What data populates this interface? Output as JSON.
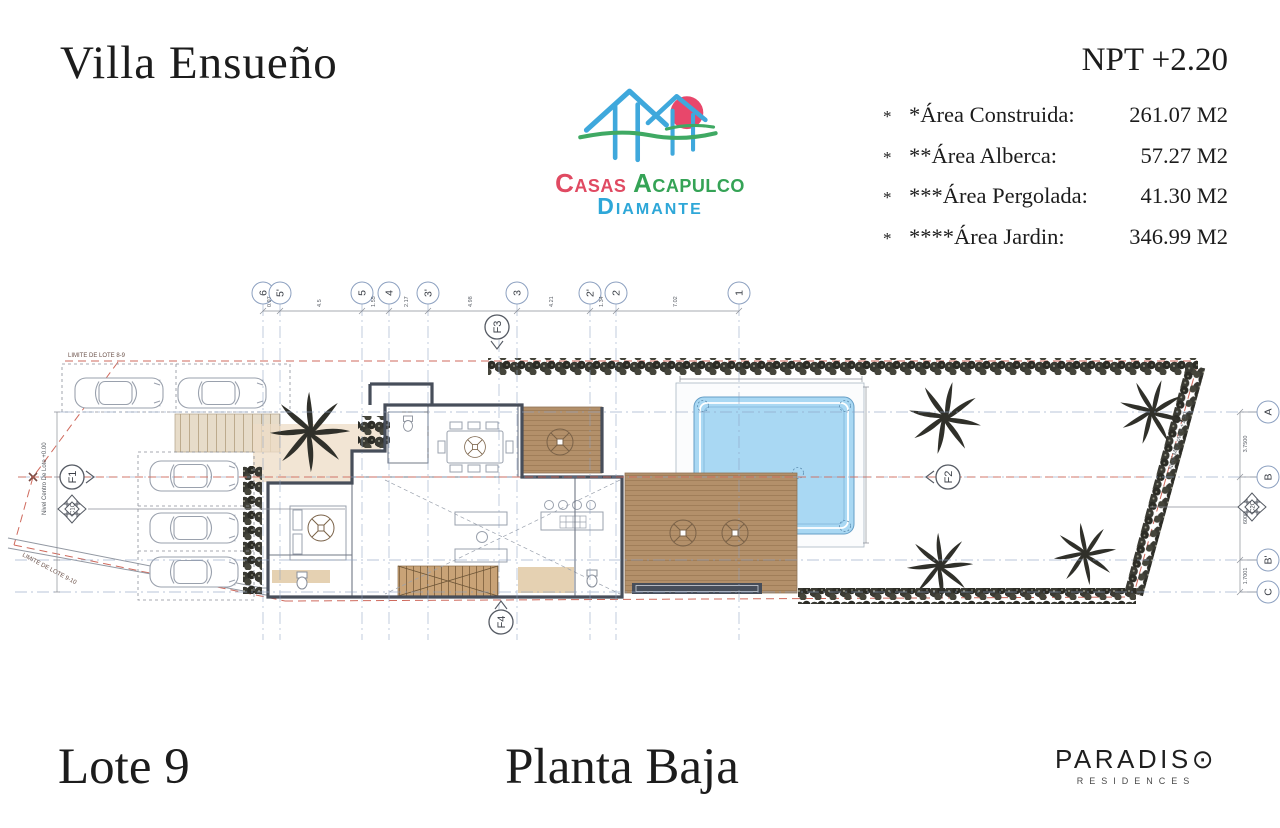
{
  "header": {
    "title": "Villa Ensueño",
    "npt": "NPT +2.20"
  },
  "areas": {
    "rows": [
      {
        "star": "*",
        "label": "*Área Construida:",
        "value": "261.07 M2"
      },
      {
        "star": "*",
        "label": "**Área Alberca:",
        "value": "57.27 M2"
      },
      {
        "star": "*",
        "label": "***Área Pergolada:",
        "value": "41.30 M2"
      },
      {
        "star": "*",
        "label": "****Área Jardin:",
        "value": "346.99 M2"
      }
    ]
  },
  "logo": {
    "casas": "Casas",
    "acapulco": "Acapulco",
    "diamante": "Diamante"
  },
  "footer": {
    "lot": "Lote 9",
    "floor": "Planta Baja",
    "brand": "PARADIS",
    "brand_o": "⊙",
    "brand_sub": "RESIDENCES"
  },
  "plan": {
    "grid_cols": [
      "6",
      "5'",
      "5",
      "4",
      "3'",
      "3",
      "2'",
      "2",
      "1"
    ],
    "col_dims": [
      "0.97",
      "4.5",
      "1.55",
      "2.17",
      "4.98",
      "4.21",
      "1.34",
      "7.02"
    ],
    "grid_rows": [
      "A",
      "B",
      "B'",
      "C"
    ],
    "row_dims": [
      "3.7500",
      "6000",
      "1.7001"
    ],
    "sections": {
      "f1": "F1",
      "f2": "F2",
      "f3": "F3",
      "f4": "F4",
      "c1c": "C1C",
      "c2c": "C2C"
    },
    "labels": {
      "limite_8_9": "LIMITE DE LOTE 8-9",
      "limite_9_10": "LIMITE DE LOTE 9-10",
      "nivel_right": "Nivel MS Lote 9 +1.50",
      "nivel_left": "Nivel Centro De Lote +0.00"
    },
    "colors": {
      "wall": "#474e5a",
      "wood": "#b3906a",
      "pool_water": "#a9d8f3",
      "stairs": "#e7dcc9",
      "hedge": "#34332c",
      "boundary_red": "#cf6a5d",
      "grid_blue": "#8ca0c0",
      "logo_blue": "#3fa8dc",
      "logo_red": "#e8476b",
      "logo_green": "#3fa963"
    }
  }
}
